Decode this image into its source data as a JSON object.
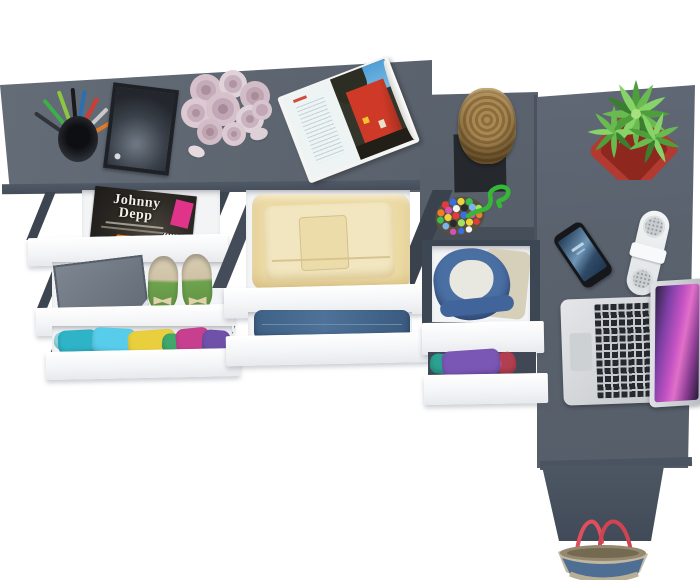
{
  "scene": {
    "description": "Top-down 3D render of an anthracite grey L-shaped desk and drawer chests with pulled-out white drawers",
    "view": "bird's-eye",
    "background_color": "#ffffff"
  },
  "palette": {
    "desk_top": "#5d6570",
    "desk_edge": "#49525e",
    "desk_leg": "#4d5663",
    "drawer_front": "#f4f5f7",
    "drawer_interior": "#f3f4f6",
    "pot_red": "#b23a30",
    "plant_green": "#5fae46",
    "stool_wood": "#a07c46",
    "laptop_body": "#d9dcde",
    "laptop_screen": "#c653c4",
    "phone_body": "#16171b",
    "speaker_white": "#eef1f2",
    "jeans_blue": "#47688c",
    "hoodie_blue": "#4a6fa3",
    "shoe_green": "#6da24e",
    "magazine_badge_pink": "#e0338a",
    "bag_denim": "#4e6f93",
    "bag_trim": "#c2b7a0",
    "bag_handles": "#e14f5d",
    "candy_cord_green": "#36b836"
  },
  "magazine": {
    "title_top": "Johnny",
    "title_bottom": "Depp"
  },
  "objects": [
    {
      "name": "pen-cup",
      "label": "pen cup with colored pens"
    },
    {
      "name": "picture-frame",
      "label": "dark picture frame"
    },
    {
      "name": "rose-bouquet",
      "label": "pale pink roses"
    },
    {
      "name": "open-magazine",
      "label": "open magazine with red building photo"
    },
    {
      "name": "wooden-stool",
      "label": "log stool on black mat"
    },
    {
      "name": "candy-pouch",
      "label": "beaded pouch with green cord"
    },
    {
      "name": "potted-plant",
      "label": "succulent in red pot"
    },
    {
      "name": "smartphone",
      "label": "smartphone"
    },
    {
      "name": "bluetooth-speaker",
      "label": "white capsule speaker"
    },
    {
      "name": "laptop",
      "label": "open silver laptop"
    },
    {
      "name": "tote-bag",
      "label": "denim tote bag with red handles"
    },
    {
      "name": "magazine-drawer",
      "label": "drawer with Johnny Depp magazine"
    },
    {
      "name": "shoe-drawer",
      "label": "drawer with shoebox and green flats"
    },
    {
      "name": "clothes-drawer",
      "label": "drawer with folded colorful clothes"
    },
    {
      "name": "linen-drawer",
      "label": "drawer with folded yellow linens"
    },
    {
      "name": "jeans-drawer",
      "label": "drawer with folded jeans"
    },
    {
      "name": "hoodie-drawer",
      "label": "drawer with blue hoodie"
    },
    {
      "name": "purple-clothes-drawer",
      "label": "drawer with purple and teal clothes"
    }
  ]
}
